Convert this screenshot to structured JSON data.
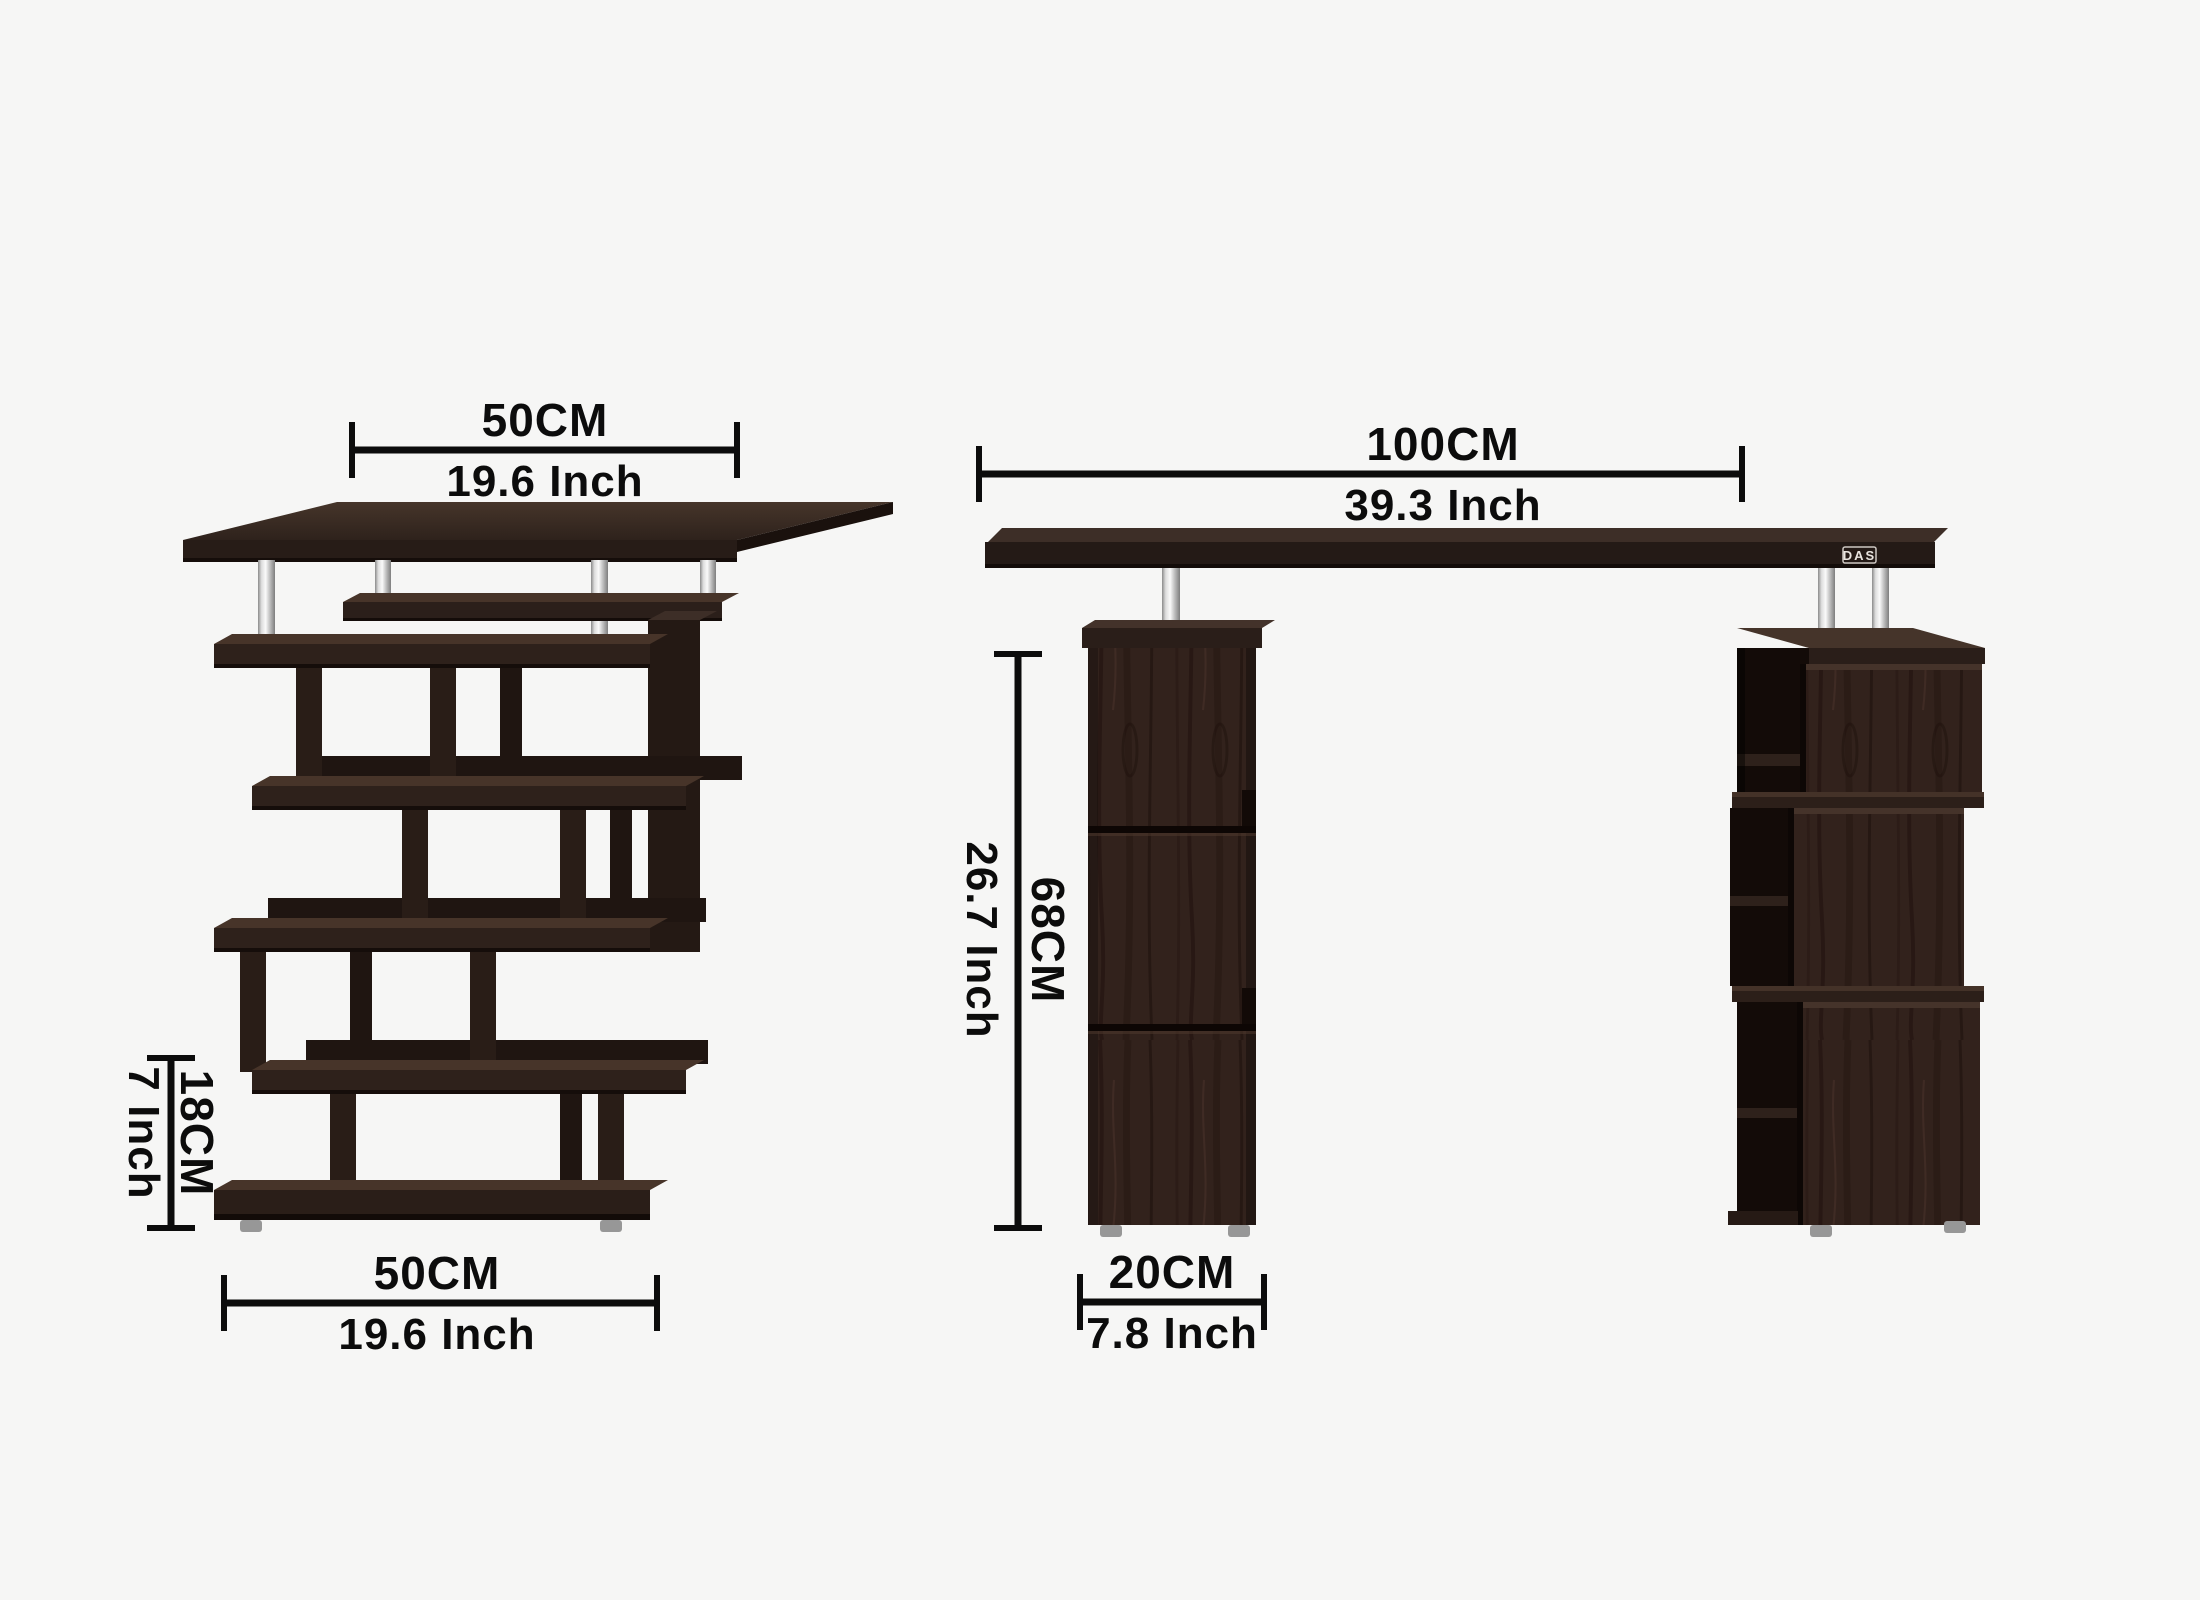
{
  "colors": {
    "background": "#f6f6f5",
    "dimension_line": "#0c0c0c",
    "wood_face": "#2a1e19",
    "wood_top": "#3d2e27",
    "chrome": "#d9d9d9"
  },
  "side_view": {
    "top_dimension": {
      "cm": "50CM",
      "inch": "19.6 Inch"
    },
    "shelf_height_dimension": {
      "cm": "18CM",
      "inch": "7 Inch"
    },
    "base_dimension": {
      "cm": "50CM",
      "inch": "19.6 Inch"
    }
  },
  "front_view": {
    "width_dimension": {
      "cm": "100CM",
      "inch": "39.3 Inch"
    },
    "height_dimension": {
      "cm": "68CM",
      "inch": "26.7 Inch"
    },
    "pedestal_dimension": {
      "cm": "20CM",
      "inch": "7.8 Inch"
    },
    "logo": "DAS"
  }
}
